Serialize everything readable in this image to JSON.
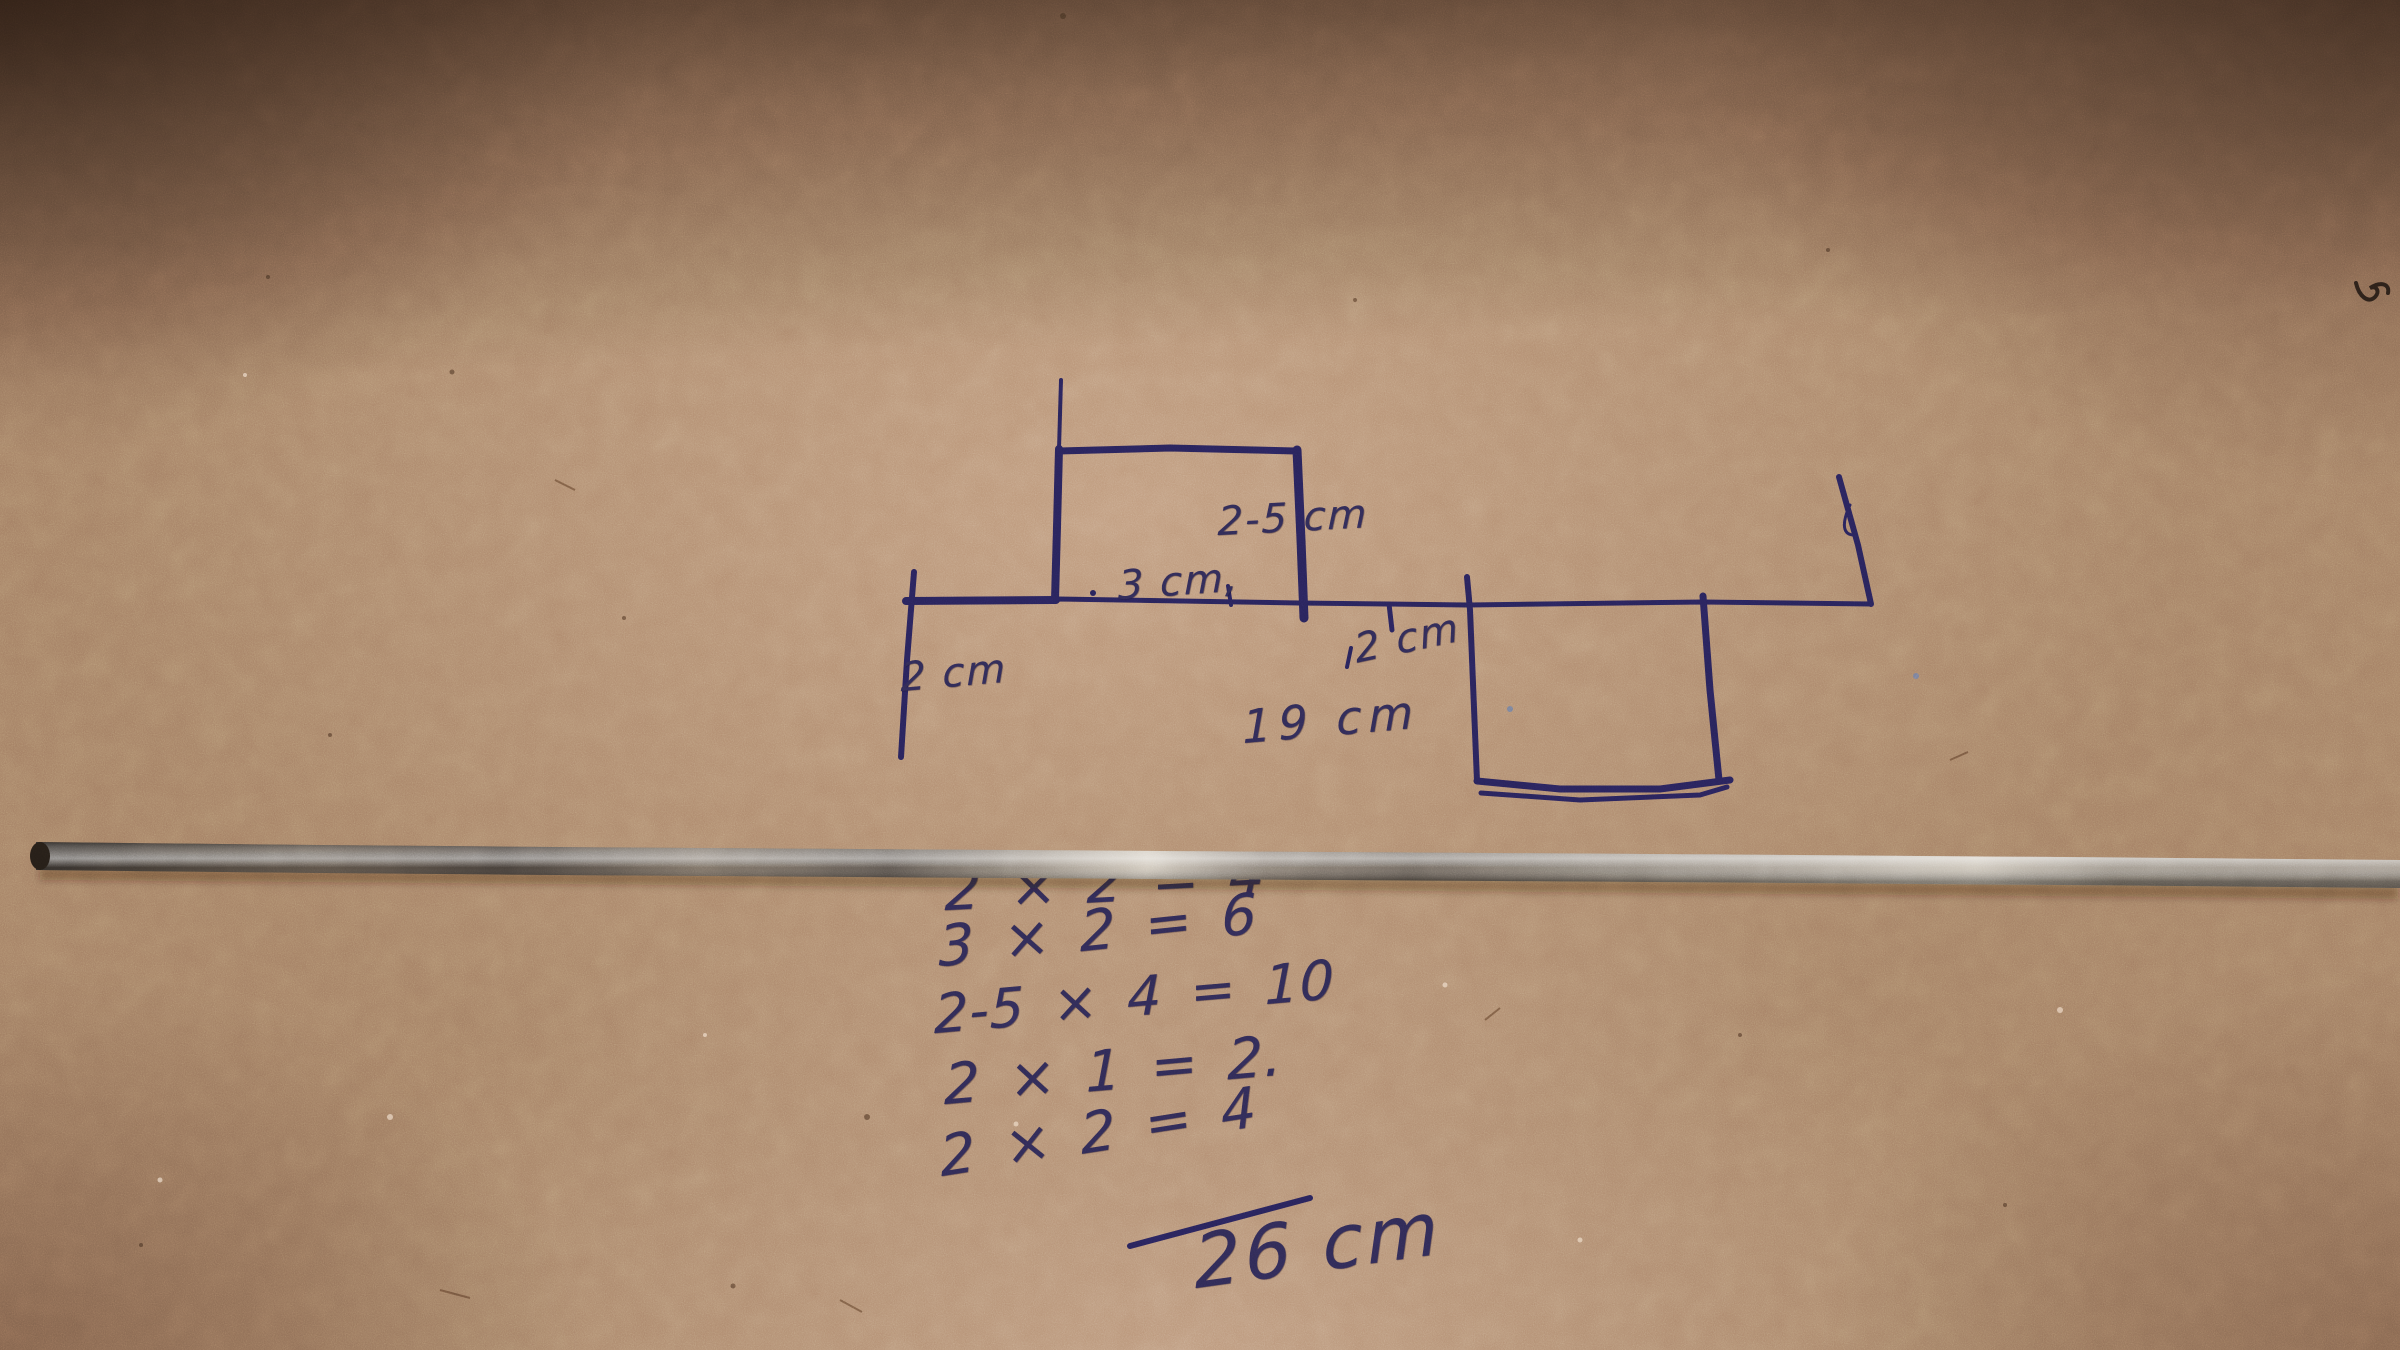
{
  "figure": {
    "labels": {
      "left_height": "2 cm",
      "top_width": "3 cm,",
      "rect_height": "2-5 cm",
      "step_width": "2 cm",
      "base_length": "19 cm"
    }
  },
  "work": {
    "lines": [
      "2 × 2 = 4",
      "3 × 2 = 6",
      "2-5 × 4 = 10",
      "2 × 1 = 2.",
      "2 × 2 = 4"
    ],
    "total": "26 cm"
  },
  "colors": {
    "ink": "#272257",
    "pen_text": "#2e2952",
    "cardboard": "#a37e63",
    "rod_dark": "#241d17",
    "rod_highlight": "#c9c0b2"
  }
}
